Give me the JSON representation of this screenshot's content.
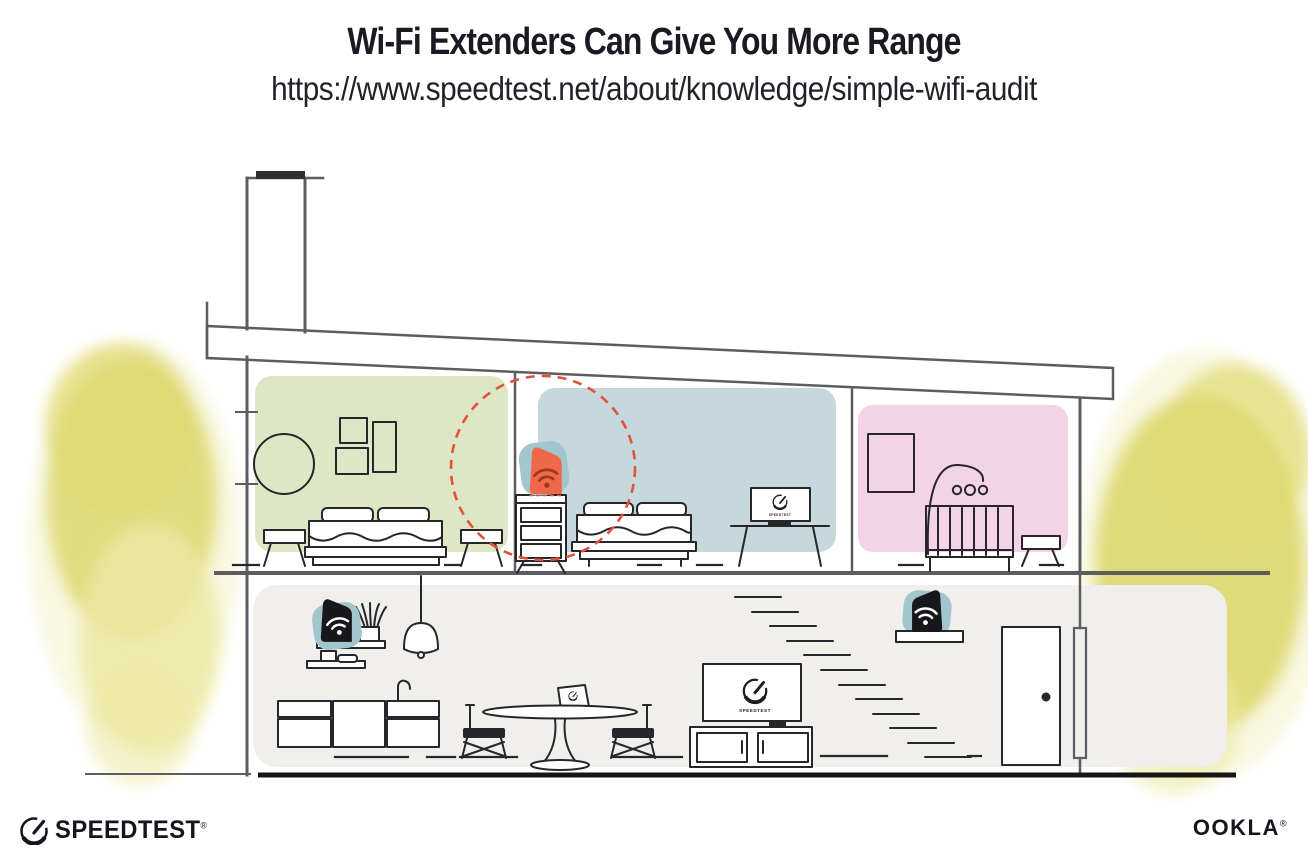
{
  "header": {
    "title": "Wi-Fi Extenders Can Give You More Range",
    "url": "https://www.speedtest.net/about/knowledge/simple-wifi-audit"
  },
  "illustration": {
    "tv_label_bedroom": "SPEEDTEST",
    "tv_label_living_room": "SPEEDTEST",
    "devices": [
      {
        "id": "router-living-room-shelf",
        "icon": "wifi-icon",
        "highlighted": false
      },
      {
        "id": "extender-stair-shelf",
        "icon": "wifi-icon",
        "highlighted": false
      },
      {
        "id": "extender-upstairs-dresser",
        "icon": "wifi-icon",
        "highlighted": true
      }
    ],
    "colors": {
      "room_green": "#dde6c5",
      "room_blue": "#c6d8dc",
      "room_pink": "#f3d3e6",
      "floor_gray": "#f0efec",
      "device_teal": "#a2c6ce",
      "device_dark": "#17171c",
      "extender_orange": "#f0684a",
      "wifi_on_orange": "#9c3a1c",
      "range_red": "#e2523a",
      "foliage_yellow": "#dcd669",
      "foliage_light": "#ece9a4",
      "structure_gray": "#5d5d61",
      "ink": "#26262b",
      "ground": "#161616",
      "title_ink": "#1b1a24"
    }
  },
  "footer": {
    "speedtest_label": "SPEEDTEST",
    "speedtest_reg": "®",
    "ookla_label": "OOKLA",
    "ookla_reg": "®"
  }
}
